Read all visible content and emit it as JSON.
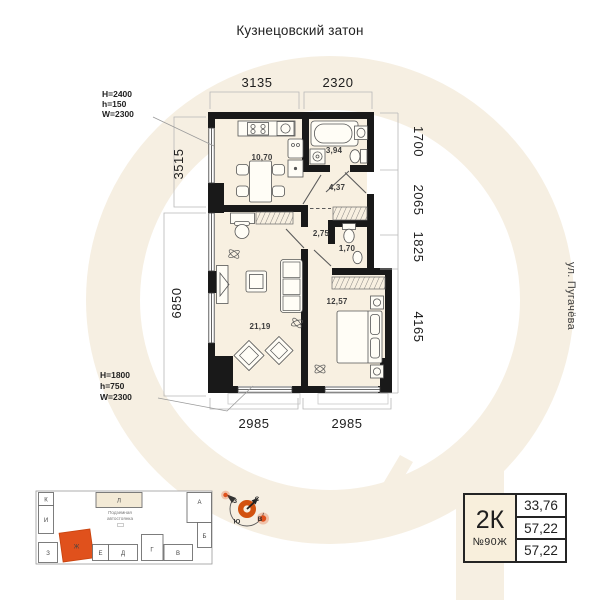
{
  "title": "Кузнецовский затон",
  "street_label": "ул. Пугачёва",
  "plan": {
    "rooms": {
      "kitchen": "10,70",
      "bathroom": "3,94",
      "hallway": "4,37",
      "corridor": "2,75",
      "wc": "1,70",
      "living_room": "21,19",
      "bedroom": "12,57"
    },
    "dimensions": {
      "top": [
        "3135",
        "2320"
      ],
      "left": [
        "3515",
        "6850"
      ],
      "right": [
        "1700",
        "2065",
        "1825",
        "4165"
      ],
      "bottom": [
        "2985",
        "2985"
      ]
    },
    "window_specs": {
      "top": [
        "H=2400",
        "h=150",
        "W=2300"
      ],
      "bottom": [
        "H=1800",
        "h=750",
        "W=2300"
      ]
    }
  },
  "site_plan": {
    "buildings": [
      "К",
      "Л",
      "А",
      "И",
      "Б",
      "З",
      "Ж",
      "Е",
      "Д",
      "Г",
      "В"
    ],
    "highlighted_building": "Ж",
    "parking_label": [
      "Подземная",
      "автостоянка"
    ]
  },
  "compass": {
    "north": "С",
    "south": "Ю",
    "west": "З",
    "east": "В"
  },
  "info_card": {
    "type": "2К",
    "number": "№90Ж",
    "areas": [
      "33,76",
      "57,22",
      "57,22"
    ]
  },
  "colors": {
    "accent": "#e0511c",
    "wall": "#1a1a1a",
    "floor": "#f8f0e1",
    "watermark": "#f6efe2",
    "card_bg": "#f8efdc"
  }
}
